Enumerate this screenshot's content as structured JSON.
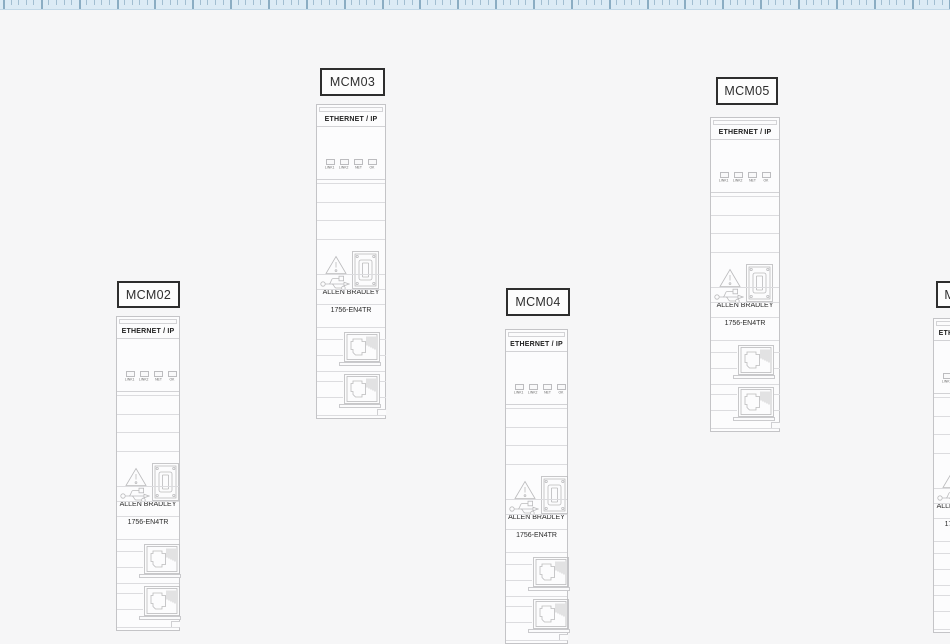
{
  "ruler": {
    "orientation": "horizontal",
    "minor_spacing": 7.571,
    "major_every": 5,
    "offset": 3
  },
  "colors": {
    "canvas_bg": "#f6f6f7",
    "ruler_bg": "#dcebf5",
    "tick_minor": "#a2bed1",
    "tick_major": "#8badc3",
    "module_outline": "#c4c4c7",
    "module_line": "#dcdcdf",
    "tag_border": "#2e2e2e",
    "icon_stroke": "#bababc",
    "text": "#2b2b2b"
  },
  "modules": [
    {
      "label": "MCM02",
      "header": "ETHERNET / IP",
      "leds": [
        "LINK1",
        "LINK2",
        "NET",
        "OK"
      ],
      "brand": "ALLEN BRADLEY",
      "model": "1756-EN4TR",
      "x": 116,
      "width": 64,
      "module_top": 316,
      "tag": {
        "x": 117,
        "y": 281,
        "w": 63,
        "h": 27
      }
    },
    {
      "label": "MCM03",
      "header": "ETHERNET / IP",
      "leds": [
        "LINK1",
        "LINK2",
        "NET",
        "OK"
      ],
      "brand": "ALLEN BRADLEY",
      "model": "1756-EN4TR",
      "x": 316,
      "width": 70,
      "module_top": 104,
      "tag": {
        "x": 320,
        "y": 68,
        "w": 65,
        "h": 28
      }
    },
    {
      "label": "MCM04",
      "header": "ETHERNET / IP",
      "leds": [
        "LINK1",
        "LINK2",
        "NET",
        "OK"
      ],
      "brand": "ALLEN BRADLEY",
      "model": "1756-EN4TR",
      "x": 505,
      "width": 63,
      "module_top": 329,
      "tag": {
        "x": 506,
        "y": 288,
        "w": 64,
        "h": 28
      }
    },
    {
      "label": "MCM05",
      "header": "ETHERNET / IP",
      "leds": [
        "LINK1",
        "LINK2",
        "NET",
        "OK"
      ],
      "brand": "ALLEN BRADLEY",
      "model": "1756-EN4TR",
      "x": 710,
      "width": 70,
      "module_top": 117,
      "tag": {
        "x": 716,
        "y": 77,
        "w": 62,
        "h": 28
      }
    },
    {
      "label": "MCM06",
      "header": "ETHERNET / IP",
      "leds": [
        "LINK1",
        "LINK2",
        "NET",
        "OK"
      ],
      "brand": "ALLEN BRADLEY",
      "model": "1756-EN4TR",
      "x": 933,
      "width": 64,
      "module_top": 318,
      "tag": {
        "x": 936,
        "y": 281,
        "w": 62,
        "h": 27
      }
    }
  ]
}
